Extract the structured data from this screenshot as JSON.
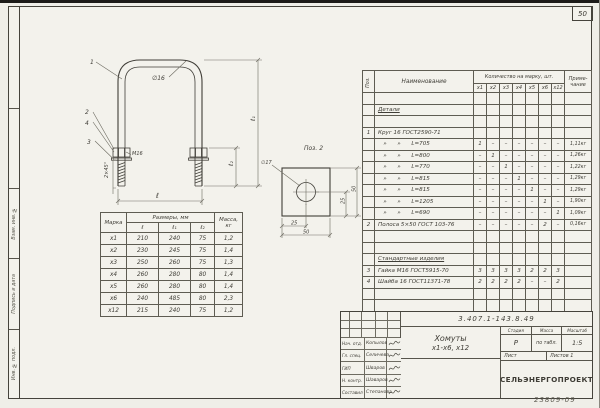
{
  "page": {
    "sheet_number": "50",
    "archive_number": "23809-09"
  },
  "edge": {
    "segments": [
      {
        "h": 102,
        "label": ""
      },
      {
        "h": 80,
        "label": ""
      },
      {
        "h": 70,
        "label": "Взам. инв. №"
      },
      {
        "h": 70,
        "label": "Подпись и дата"
      },
      {
        "h": 69,
        "label": "Инв. № подл."
      }
    ]
  },
  "drawing": {
    "callout_1": "1",
    "callout_2": "2",
    "callout_4": "4",
    "callout_3": "3",
    "rod_dia": "∅16",
    "thread": "М16",
    "chamfer": "2×45°",
    "dim_l": "ℓ",
    "dim_l1": "ℓ₁",
    "dim_l2": "ℓ₂"
  },
  "plate_view": {
    "title": "Поз. 2",
    "hole_dia": "∅17",
    "dim_half_h": "25",
    "dim_full_h": "50",
    "dim_half_v": "25",
    "dim_full_v": "50"
  },
  "size_table": {
    "header_mark": "Марка",
    "header_dims": "Размеры, мм",
    "header_l": "ℓ",
    "header_l1": "ℓ₁",
    "header_l2": "ℓ₂",
    "header_mass": "Масса,\nкг",
    "rows": [
      {
        "mark": "х1",
        "l": "210",
        "l1": "240",
        "l2": "75",
        "mass": "1,2"
      },
      {
        "mark": "х2",
        "l": "230",
        "l1": "245",
        "l2": "75",
        "mass": "1,4"
      },
      {
        "mark": "х3",
        "l": "250",
        "l1": "260",
        "l2": "75",
        "mass": "1,3"
      },
      {
        "mark": "х4",
        "l": "260",
        "l1": "280",
        "l2": "80",
        "mass": "1,4"
      },
      {
        "mark": "х5",
        "l": "260",
        "l1": "280",
        "l2": "80",
        "mass": "1,4"
      },
      {
        "mark": "х6",
        "l": "240",
        "l1": "485",
        "l2": "80",
        "mass": "2,3"
      },
      {
        "mark": "х12",
        "l": "215",
        "l1": "240",
        "l2": "75",
        "mass": "1,2"
      }
    ]
  },
  "spec_table": {
    "header_pos": "Поз.",
    "header_name": "Наименование",
    "header_qty": "Количество на марку, шт.",
    "header_note": "Приме-\nчание",
    "marks": [
      "х1",
      "х2",
      "х3",
      "х4",
      "х5",
      "х6",
      "х12"
    ],
    "ditto_mark": "»",
    "rows": [
      {
        "type": "blank"
      },
      {
        "type": "section",
        "title": "Детали"
      },
      {
        "type": "blank"
      },
      {
        "type": "item",
        "pos": "1",
        "name": "Круг 16 ГОСТ2590-71",
        "qty": [
          "",
          "",
          "",
          "",
          "",
          "",
          ""
        ],
        "note": ""
      },
      {
        "type": "len",
        "len": "L=705",
        "qty": [
          "1",
          "–",
          "–",
          "–",
          "–",
          "–",
          "–"
        ],
        "note": "1,11кг"
      },
      {
        "type": "len",
        "len": "L=800",
        "qty": [
          "–",
          "1",
          "–",
          "–",
          "–",
          "–",
          "–"
        ],
        "note": "1,26кг"
      },
      {
        "type": "len",
        "len": "L=770",
        "qty": [
          "–",
          "–",
          "1",
          "–",
          "–",
          "–",
          "–"
        ],
        "note": "1,22кг"
      },
      {
        "type": "len",
        "len": "L=815",
        "qty": [
          "–",
          "–",
          "–",
          "1",
          "–",
          "–",
          "–"
        ],
        "note": "1,29кг"
      },
      {
        "type": "len",
        "len": "L=815",
        "qty": [
          "–",
          "–",
          "–",
          "–",
          "1",
          "–",
          "–"
        ],
        "note": "1,29кг"
      },
      {
        "type": "len",
        "len": "L=1205",
        "qty": [
          "–",
          "–",
          "–",
          "–",
          "–",
          "1",
          "–"
        ],
        "note": "1,90кг"
      },
      {
        "type": "len",
        "len": "L=690",
        "qty": [
          "–",
          "–",
          "–",
          "–",
          "–",
          "–",
          "1"
        ],
        "note": "1,09кг"
      },
      {
        "type": "item",
        "pos": "2",
        "name": "Полоса 5×50 ГОСТ 103-76",
        "qty": [
          "–",
          "–",
          "–",
          "–",
          "–",
          "2",
          "–"
        ],
        "note": "0,16кг"
      },
      {
        "type": "blank"
      },
      {
        "type": "blank"
      },
      {
        "type": "section",
        "title": "Стандартные изделия"
      },
      {
        "type": "item",
        "pos": "3",
        "name": "Гайка М16 ГОСТ5915-70",
        "qty": [
          "3",
          "3",
          "3",
          "3",
          "2",
          "2",
          "3"
        ],
        "note": ""
      },
      {
        "type": "item",
        "pos": "4",
        "name": "Шайба 16 ГОСТ11371-78",
        "qty": [
          "2",
          "2",
          "2",
          "2",
          "–",
          "–",
          "2"
        ],
        "note": ""
      },
      {
        "type": "blank"
      },
      {
        "type": "blank"
      }
    ]
  },
  "title_block": {
    "doc_number": "3.407.1-143.8.49",
    "title_line1": "Хомуты",
    "title_line2": "х1-х6, х12",
    "stage_label": "Стадия",
    "mass_label": "Масса",
    "scale_label": "Масштаб",
    "stage_value": "Р",
    "mass_value": "по табл.",
    "scale_value": "1:5",
    "sheet_label": "Лист",
    "sheets_label": "Листов 1",
    "org": "СЕЛЬЭНЕРГОПРОЕКТ",
    "signers": [
      {
        "role": "Нач. отд.",
        "name": "Копылов"
      },
      {
        "role": "Гл. спец.",
        "name": "Селичева"
      },
      {
        "role": "ГИП",
        "name": "Шваров"
      },
      {
        "role": "Н. контр.",
        "name": "Шаваров"
      },
      {
        "role": "Составил",
        "name": "Степанова"
      }
    ]
  },
  "colors": {
    "ink": "#403e38",
    "dim_line": "#6e6c62",
    "paper": "#f3f2ec"
  }
}
